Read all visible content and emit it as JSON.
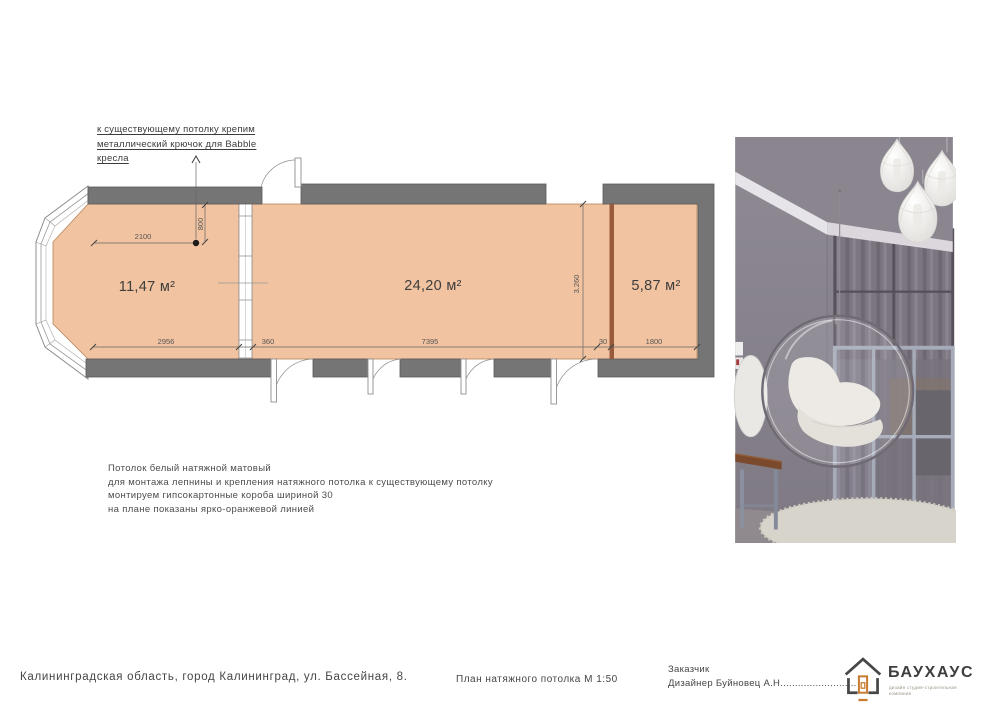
{
  "sheet": {
    "annotation": {
      "line1": "к существующему потолку крепим",
      "line2": "металлический крючок для Babble",
      "line3": "кресла"
    },
    "plan": {
      "areas": {
        "bay": "11,47 м²",
        "main": "24,20 м²",
        "right": "5,87 м²"
      },
      "dims": {
        "w2100": "2100",
        "h800": "800",
        "w2956": "2956",
        "w360": "360",
        "w7395": "7395",
        "w30": "30",
        "w1800": "1800",
        "h3260": "3.260"
      },
      "colors": {
        "ceiling_fill": "#f1c3a0",
        "wall": "#757575",
        "orange_box_line": "#9a5a3c"
      }
    },
    "notes": {
      "line1": "Потолок белый натяжной матовый",
      "line2": "для монтажа лепнины и крепления натяжного потолка к существующему потолку",
      "line3": "монтируем гипсокартонные короба шириной 30",
      "line4": "на плане показаны ярко-оранжевой линией"
    },
    "footer": {
      "address": "Калининградская область, город Калининград, ул. Бассейная, 8.",
      "drawing_title": "План натяжного потолка М 1:50",
      "client_label": "Заказчик",
      "designer_line": "Дизайнер Буйновец А.Н..........................",
      "brand": {
        "name": "БАУХАУС",
        "subtitle_line1": "дизайн студия-строительная",
        "subtitle_line2": "компания",
        "accent": "#c97b2f"
      }
    }
  }
}
